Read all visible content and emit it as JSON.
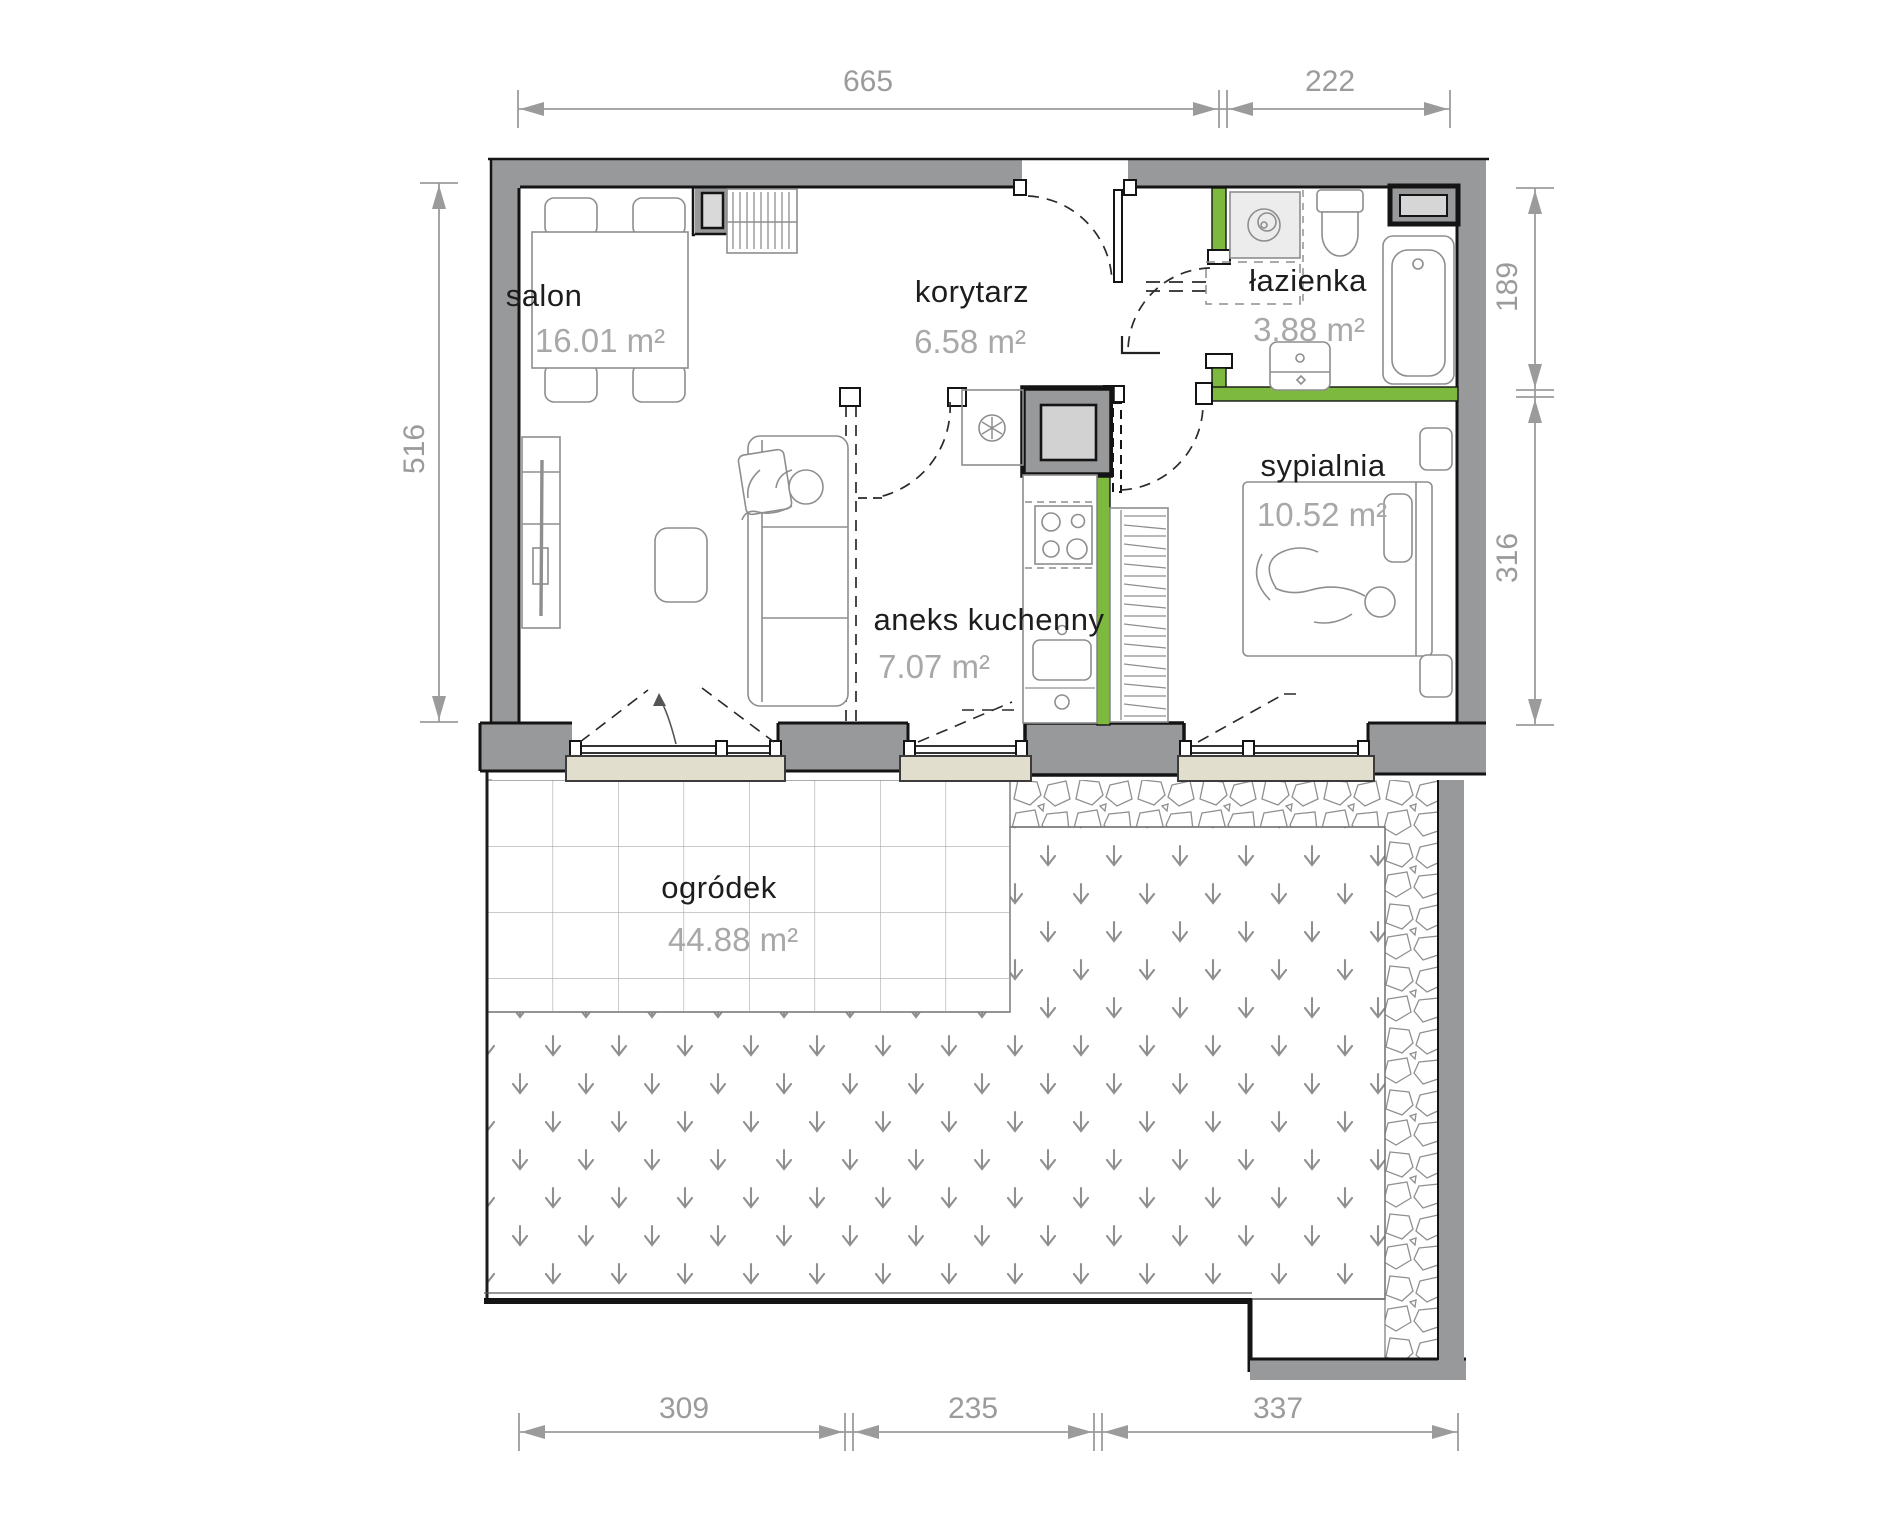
{
  "title": "apartment-floor-plan",
  "rooms": [
    {
      "name": "salon",
      "area": "16.01 m²"
    },
    {
      "name": "korytarz",
      "area": "6.58 m²"
    },
    {
      "name": "łazienka",
      "area": "3.88 m²"
    },
    {
      "name": "sypialnia",
      "area": "10.52 m²"
    },
    {
      "name": "aneks kuchenny",
      "area": "7.07 m²"
    },
    {
      "name": "ogródek",
      "area": "44.88 m²"
    }
  ],
  "dimensions": {
    "top": [
      "665",
      "222"
    ],
    "left": [
      "516"
    ],
    "right": [
      "189",
      "316"
    ],
    "bottom": [
      "309",
      "235",
      "337"
    ]
  },
  "colors": {
    "wall": "#97999b",
    "accent_green": "#7cb93e",
    "sill": "#e2decd",
    "dimension": "#9b9b9b",
    "room_text": "#1d1d1d",
    "area_text": "#a8a8a8"
  },
  "fixtures": [
    "dining-table",
    "chair",
    "tv-stand",
    "sofa",
    "coffee-table",
    "corridor-wardrobe",
    "washing-machine",
    "toilet",
    "bathroom-sink",
    "bathtub",
    "installation-shaft",
    "extractor-fan",
    "hob",
    "kitchen-sink",
    "kitchen-counter",
    "bed",
    "nightstand",
    "bedroom-wardrobe",
    "terrace-tiles",
    "lawn",
    "stone-path"
  ]
}
